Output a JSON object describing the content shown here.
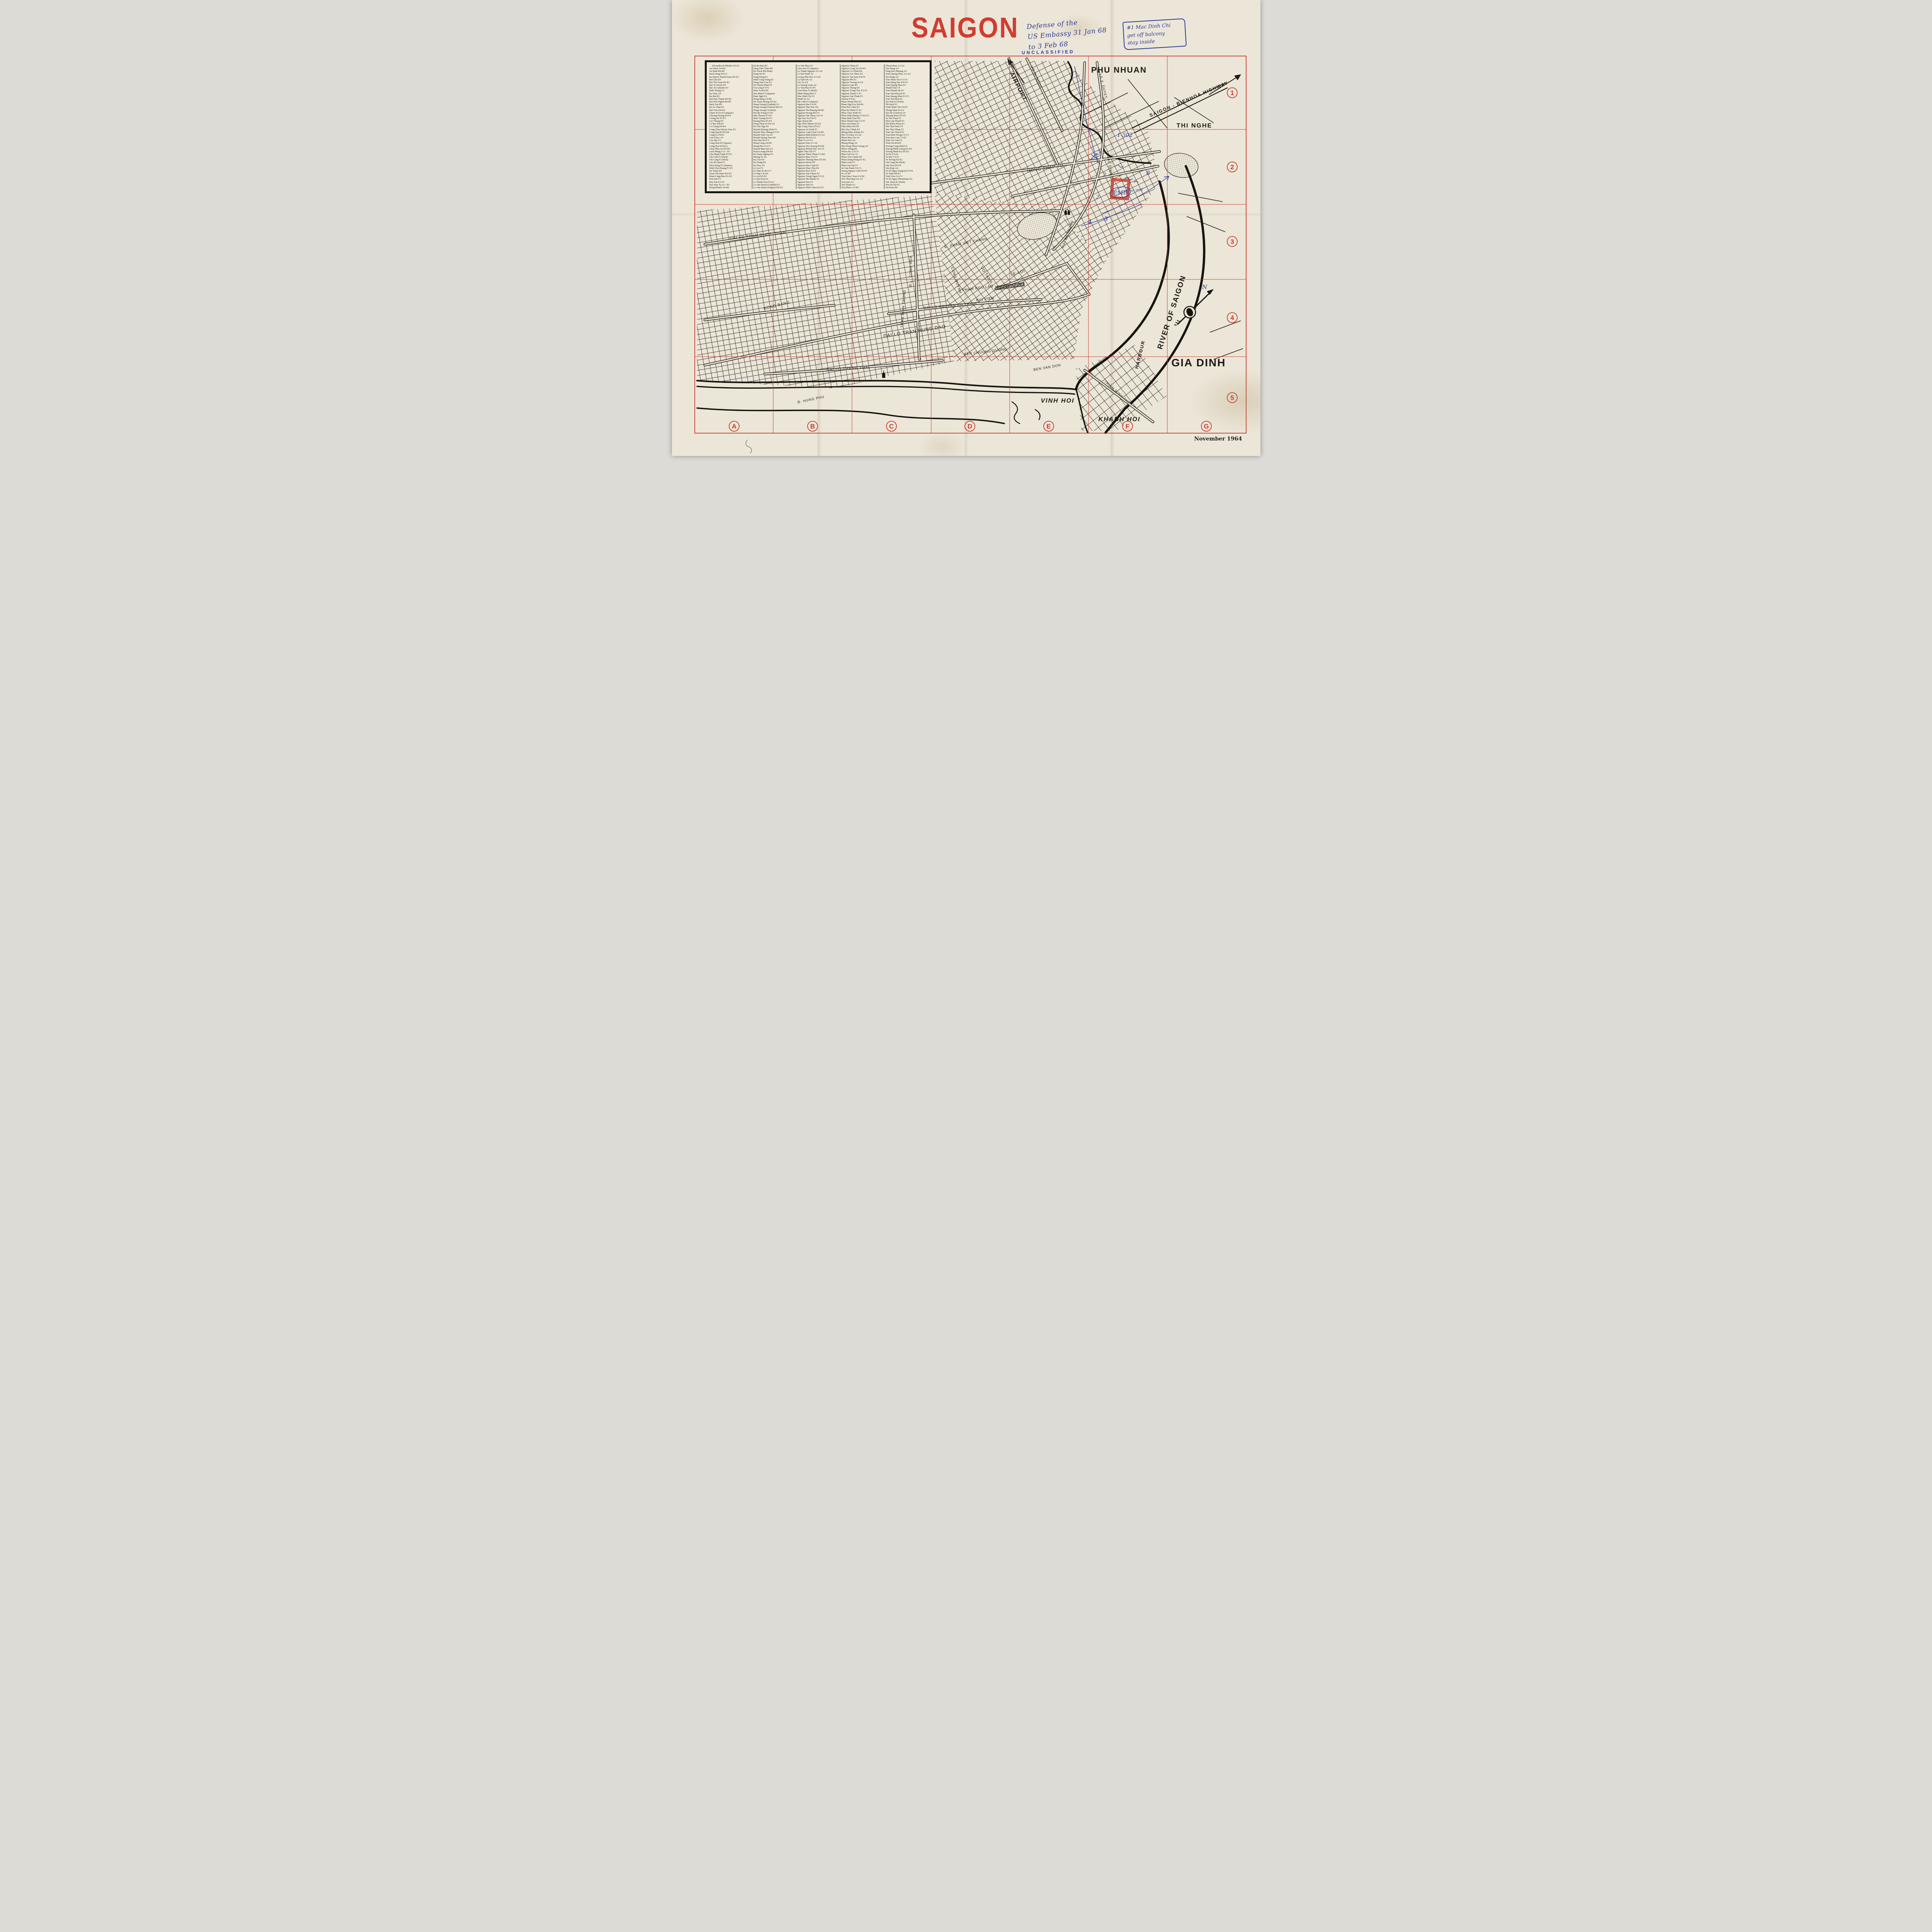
{
  "page": {
    "title": "SAIGON",
    "date": "November 1964",
    "classification": "UNCLASSIFIED"
  },
  "annotations": {
    "defense_note_lines": [
      "Defense of the",
      "US Embassy 31 Jan 68",
      "to 3 Feb 68"
    ],
    "corner_note_lines": [
      "#1 Mac Dinh Chi",
      "get off balcony",
      "stay inside"
    ],
    "embassy": {
      "emb": "EMB",
      "code": "1-502",
      "roof": "3 on roof",
      "digits": [
        "3",
        "2",
        "2",
        "4",
        "5",
        "8"
      ]
    }
  },
  "grid": {
    "letters": [
      "A",
      "B",
      "C",
      "D",
      "E",
      "F",
      "G"
    ],
    "numbers": [
      "1",
      "2",
      "3",
      "4",
      "5"
    ]
  },
  "map": {
    "districts": {
      "phu_nhuan": "PHU NHUAN",
      "thi_nghe": "THI NGHE",
      "gia_dinh": "GIA DINH",
      "vinh_hoi": "VINH HOI",
      "khanh_hoi": "KHANH HOI"
    },
    "water": {
      "river": "RIVER OF SAIGON",
      "harbour": "HARBOUR"
    },
    "routes": {
      "highway": "SAIGON - BIENHOA HIGHWAY",
      "airport": "AIRPORT"
    },
    "compass_n": "N",
    "streets": {
      "tran_quoc_toan": "DAI LO TRAN QUOC TOAN",
      "hong_bang": "HONG BANG",
      "thanh_thai": "DAI LO THANH THAI",
      "tran_hung_dao": "DAI LO TRAN HUNG DAO",
      "nguyen_cu_trinh": "DAI LO NGUYEN CU TRINH",
      "pham_ngu_lao": "PHAM NGU LAO",
      "bui_vien": "BUI VIEN",
      "cong_quynh": "CONG QUYNH",
      "cong_hoa": "Đ.L. CONG HOA",
      "tran_binh_trong": "TRAN BINH TRONG",
      "pham_viet_chanh": "Đ. PHAM VIET CHANH",
      "vo_tanh": "VO TANH",
      "hong_thap_tu": "HONG THAP TU",
      "mac_dinh_chi": "MAC DINH CHI",
      "le_loi": "LE-LOI",
      "hai_ba_trung": "HAI BA TRUNG",
      "le_van_duyet": "LE V. DUYET",
      "vo_di_nguy": "VO DI NGUY",
      "ben_chuong_duong": "BEN CHUONG DUONG",
      "ben_van_don": "BEN VAN DON",
      "hung_phu": "Đ. HUNG PHU",
      "trinh_minh_the": "TRINH MINH THE"
    }
  },
  "index": {
    "columns": [
      [
        "Alexandre de Rhodes E3-F2",
        "An Diem A4-B4",
        "An Binh B4-B5",
        "Bach Dang F4-G3",
        "Ba Huyen Thanh Quan D2-E3",
        "Bui Chu D3",
        "Bui Thi Xuan D3-E3",
        "Bac Si Yersin E4",
        "Bac Si Calmette E4",
        "Binh Thang A3",
        "Ba Trieu A4",
        "Ba Hat B3",
        "Bui Duy Thanh B4-B5",
        "Bui Huu Nghia B4-B5",
        "Bach Van B5",
        "Ba Le Chan E1",
        "Bui Vien D4-E4",
        "Chien Si E2-F2 (Square)",
        "Chuong Duong E4-F4",
        "Cuong De F2-F3",
        "Cao Thang D3",
        "Co Bac D4-E4",
        "Co Giang D4-E4",
        "Cong Chua Huyen Tran E3",
        "Cong Quynh D3-D4",
        "Cong Ly F4-E1",
        "Can Giuoc A5",
        "Cao Dat C5",
        "Cong Hoa D3 (Square)",
        "Cong Hoa D4 (St.)",
        "Chua Phat An D4-D5",
        "Cach Mang I-11 - D1",
        "Chu Manh Trinh F2-F3",
        "Chi Linh F3 (Park)",
        "Chi Lang F3 (Park)",
        "Cao Ba Quat F3",
        "Dien Hong E3 (Square)",
        "Dinh Tien Hoang F1-F2",
        "De Tham E4",
        "Doan Thi Diem D2-E3",
        "Doan Cong Buu E1-E2",
        "Don Dat F3",
        "Duy Tan E2-F2",
        "Dao Duy Tu A3 - B3",
        "Dong Khanh A4-B4",
        "Dinh Hoa A5"
      ],
      [
        "Da Ba Bau B3",
        "Dang Thai Than B4",
        "Da Trach B4 (Park)",
        "Dang Tat E1",
        "Dang Dung E1",
        "Dinh Cong Trang E1",
        "Dang Tran Con E3",
        "Do Thanh Nhan F5",
        "Gia Long F3-F3",
        "Ham Tu B4-D5",
        "Hoa Binh F3 (Square)",
        "Ham Nghi F4",
        "Hong Bang A4-B4",
        "Ho Xuan Huong D3-E2",
        "Hung Vuong (Giadinh) G1",
        "Hung Vuong (Cholon) B4-C4",
        "Hung Vuong C4 (Park)",
        "Hai Ba Trung F3-E1",
        "Han Thuyen F3-F3",
        "Hien Vuong D2-F1",
        "Hoang Dieu F5-F4",
        "Hong Thap Tu D3-G2",
        "Ho Van Nga E4",
        "Huynh Khuong Ninh F1",
        "Huynh Thuc Khang E3-F3",
        "Huynh Tinh Cua E1",
        "Huynh Quang Tien D4",
        "Hoa Hao B3-C3",
        "Hung Long A4-B4",
        "Hung Phu A5-C5",
        "Huynh Man Dat C4",
        "Hoan Luong D4-E4",
        "Ho Huan Nghiep F3",
        "Khong Tu A4",
        "Ky Con E4",
        "Ky Dong D2",
        "Ky Hoa A4",
        "Le Loi F3",
        "Ly Thai To B3-C3",
        "Le Ngo Cat D2",
        "Le Lai D3-E3",
        "Le Qui Don E2",
        "Le Thanh Ton F3-G2",
        "Le Van Duyet (Giadinh) F1",
        "Le Van Duyet (Saigon) D2-E3",
        "Ly Tran Quan E1-F1"
      ],
      [
        "Ly Van Phuc F1",
        "Lam Son F3 (Square)",
        "Ly Thanh Nguyen A3-A4",
        "Le Dai Hanh A3",
        "Luong Nhu Hoc A3-A4",
        "Ly Nam De A3",
        "Lao Tu A4",
        "Le Quang Liem A4",
        "Le Van Huu F2-F3",
        "Lien Hiep F3 (Park)",
        "Minh Mang B4-C3",
        "Mac Dinh Chi F2",
        "Manh Tu A3",
        "Me Linh F3 (Square)",
        "Nguyen Hue F3-F4",
        "Nguyen Thai Hoc E4",
        "Nguyen Thi Phuong B4-B3",
        "Nguyen Hoang B4-C4",
        "Nguyen Van Thoai A4-A3",
        "Ngo Duc Ke F4-F3",
        "Ngo Quyen B4",
        "Ngo Thoi Nhiem D2-E2",
        "Ngo Tung Chau D3-E3",
        "Nguyen An Ninh E3",
        "Nguyen Canh Chan C4-D5",
        "Nguyen Binh Khiem F1-G2",
        "Nguyen Du E3-G2",
        "Nhan Vi A3-C4",
        "Nguyen Kim A3-A4",
        "Nguyen Duy Duong B3-B4",
        "Nguyen Huynh Duc A4-A5",
        "Nghia Thuc B5-C5",
        "Nguyen Thien Thuat C3-D4",
        "Nguyen Bieu C4-C5",
        "Nguyen Thuong Hien D2-D3",
        "Nguyen Khoai D5",
        "Nguyen Huu Canh E1",
        "Nguyen Khac Nhu E4",
        "Nguyen Huy Tu F1",
        "Nguyen Van Chiem F2",
        "Nguyen Trung Ngan F3-G2",
        "Nguyen Phi Khanh F1",
        "Nguyen Hau F3",
        "Nguyen Sieu F3",
        "Nguyen Dinh Chieu E2-E1",
        "Nguyen Trai A4-C4"
      ],
      [
        "Nguyen Thiep F3",
        "Nguyen Cong Tru E4-F4",
        "Nguyen Cu Trinh D4",
        "Nguyen Gia Thieu E2",
        "Nguyen Van Sam E4-F4",
        "Nguyen Phi E3",
        "Nguyen Truong To F4",
        "Nguyen Lam B3",
        "Nguyen Thong D2",
        "Nguyen Trung Truc E3-F3",
        "Nguyen Thanh Y F2",
        "Nguyen Van Thinh F3",
        "Pasteur F4-E1",
        "Pham Hong Thai E3",
        "Pham Ngu Lao D4-E4",
        "Phan Boi Chau E3",
        "Phan Ke Binh F1-F2",
        "Phan Chau Trinh E3",
        "Phan Dinh Phung C3-E2-G1",
        "Phan Dinh Toai D2",
        "Phan Thanh Gian C3-F1",
        "Phan Van Hum E3",
        "Phat Diem D4-D5",
        "Pho Duc Chinh E4",
        "Phung Khac Khoan F2",
        "Pho Co Dieu A3-A4",
        "Pham Huu Chi A4",
        "Pham Don A4",
        "Phung Hung A4",
        "Phu Dong Thien Vuong A4",
        "Phuoc Hung B4",
        "Petrus-Ky C3-C4",
        "Phan Van Tri C4",
        "Pham Viet Chanh D3",
        "Pham Dang Hung E1-E2",
        "Phan Liem F1",
        "Phan Van Dat F3",
        "Su Van Hanh C4-C3",
        "Suong Nguyet Anh D3-E3",
        "So 21 B3",
        "Tran Quoc Toan A3-D2",
        "Ton That Hiep A2-A3",
        "Tran Qui A3",
        "Tan Thanh A3",
        "Tan Phuoc A3-B3",
        "Tang Bat Ho A3-A4"
      ],
      [
        "Thuan Kieu A3-A4",
        "Tan Hung A4",
        "Tong Doc Phuong A4",
        "Trieu Quang Phuc A3-A4",
        "Tan Hang A4",
        "Tran Nhan Ton C3-C4",
        "Tran Hung Dao E4-C4",
        "Tran Quang Dieu D1",
        "Thanh Thai C4",
        "Tran Khanh Du E1",
        "Tran Qui Khoach E1",
        "Tran Quang Khai E1-F1",
        "Tran Tan Phat E2",
        "Tao Dan E3 (Park)",
        "Thi Sach F3",
        "Trinh Minh The F4-F5",
        "Thong Nhat E3-G2",
        "Tan Da (Cholon) A4",
        "Thuong Khau F5-G5",
        "Ta Thu Thau F3",
        "Thai Lap Thanh F3",
        "Thu Khoa Huan E3",
        "Ton That Dam F4",
        "Ton That Thiep F3",
        "Tran Van Thach E1",
        "Tran Binh Trong C5-C3",
        "Tran Quy Cap C3-E2",
        "Tran Cao Van F2",
        "Trieu Da B4-B3",
        "Truong Cong Dinh E3",
        "Truong Minh Giang E2-D1",
        "Truong Minh Ky D3-E3",
        "Tu Do F3-F4",
        "Tu Duc F2-F1",
        "Tu Xuong D2-E2",
        "Van Lang B4 (Park)",
        "Van Don D5-F4",
        "Van Kiep A4",
        "Vo Di Nguy (Saigon) F3-F4",
        "Vo Tanh D4-E3",
        "Vinh Vien A3-C3",
        "Vo Di Nguy (Phunhuan) E1",
        "Van Xuan E2 (Park)",
        "Yen Do D2-E1",
        "Yet Kieu B4"
      ]
    ]
  },
  "colors": {
    "accent_red": "#d23c30",
    "ink_blue": "#2c3a98",
    "paper": "#ece6d8"
  }
}
